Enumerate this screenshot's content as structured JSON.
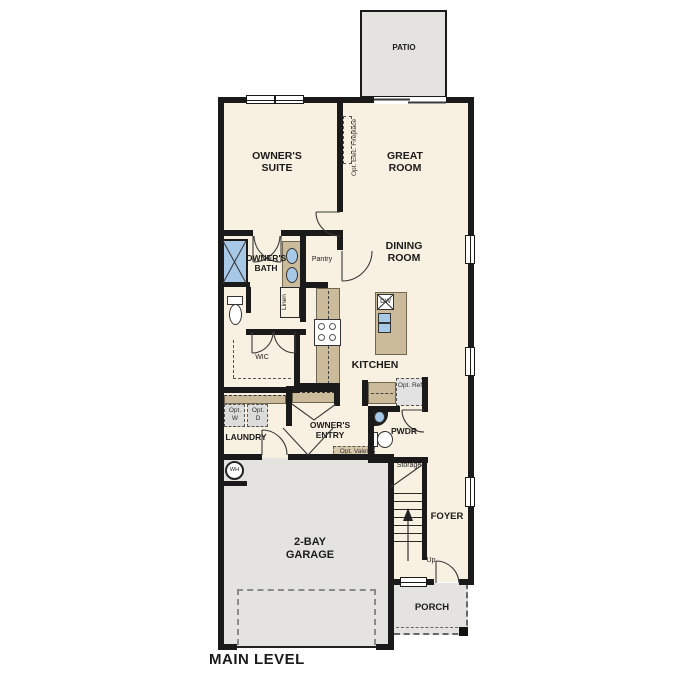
{
  "title": "MAIN LEVEL",
  "rooms": {
    "patio": "PATIO",
    "owners_suite": "OWNER'S SUITE",
    "great_room": "GREAT ROOM",
    "dining_room": "DINING ROOM",
    "kitchen": "KITCHEN",
    "owners_bath": "OWNER'S BATH",
    "pantry": "Pantry",
    "linen": "Linen",
    "wic": "WIC",
    "laundry": "LAUNDRY",
    "owners_entry": "OWNER'S ENTRY",
    "powder": "PWDR",
    "storage": "Storage",
    "foyer": "FOYER",
    "garage": "2-BAY GARAGE",
    "porch": "PORCH"
  },
  "annotations": {
    "fireplace": "Opt. Elec. Fireplace",
    "washer": "Opt. W",
    "dryer": "Opt. D",
    "refrigerator": "Opt. Ref",
    "valet": "Opt. Valet",
    "dishwasher": "DW",
    "water_heater": "WH",
    "stairs_up": "Up"
  },
  "colors": {
    "floor": "#f8f0e0",
    "exterior_concrete": "#e4e3e0",
    "cabinetry": "#cbbb9b",
    "plumbing_fixture": "#a8c8e8",
    "wall": "#1a1a1a"
  }
}
